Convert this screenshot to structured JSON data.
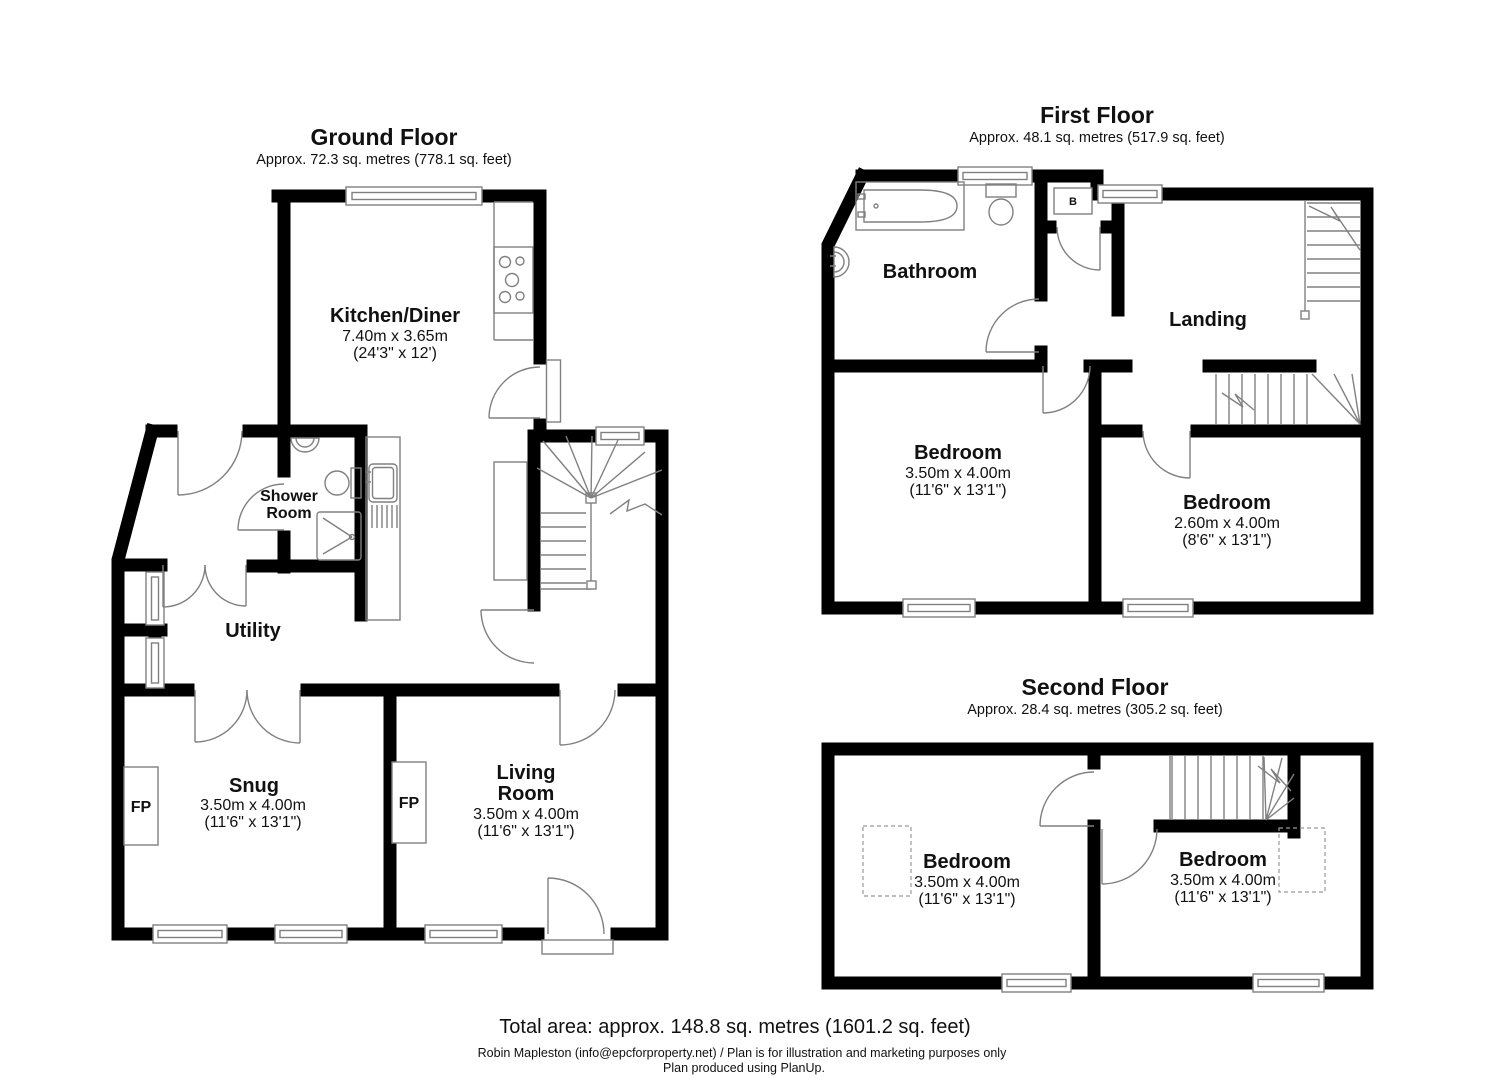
{
  "document": {
    "footer": {
      "total_area": "Total area: approx. 148.8 sq. metres (1601.2 sq. feet)",
      "credit": "Robin Mapleston (info@epcforproperty.net) / Plan is for illustration and marketing purposes only",
      "produced": "Plan produced using PlanUp."
    }
  },
  "floors": {
    "ground": {
      "title": "Ground Floor",
      "area": "Approx. 72.3 sq. metres (778.1 sq. feet)"
    },
    "first": {
      "title": "First Floor",
      "area": "Approx. 48.1 sq. metres (517.9 sq. feet)"
    },
    "second": {
      "title": "Second Floor",
      "area": "Approx. 28.4 sq. metres (305.2 sq. feet)"
    }
  },
  "rooms": {
    "kitchen_diner": {
      "name": "Kitchen/Diner",
      "metric": "7.40m x 3.65m",
      "imperial": "(24'3\" x 12')"
    },
    "shower_room": {
      "line1": "Shower",
      "line2": "Room"
    },
    "utility": {
      "name": "Utility"
    },
    "snug": {
      "name": "Snug",
      "metric": "3.50m x 4.00m",
      "imperial": "(11'6\" x 13'1\")"
    },
    "living_room": {
      "line1": "Living",
      "line2": "Room",
      "metric": "3.50m x 4.00m",
      "imperial": "(11'6\" x 13'1\")"
    },
    "bathroom": {
      "name": "Bathroom"
    },
    "landing": {
      "name": "Landing"
    },
    "first_bedroom_left": {
      "name": "Bedroom",
      "metric": "3.50m x 4.00m",
      "imperial": "(11'6\" x 13'1\")"
    },
    "first_bedroom_right": {
      "name": "Bedroom",
      "metric": "2.60m x 4.00m",
      "imperial": "(8'6\" x 13'1\")"
    },
    "second_bedroom_left": {
      "name": "Bedroom",
      "metric": "3.50m x 4.00m",
      "imperial": "(11'6\" x 13'1\")"
    },
    "second_bedroom_right": {
      "name": "Bedroom",
      "metric": "3.50m x 4.00m",
      "imperial": "(11'6\" x 13'1\")"
    }
  },
  "markers": {
    "fireplace": "FP",
    "boiler": "B"
  },
  "colors": {
    "wall": "#000000",
    "fixture_line": "#808080",
    "background": "#ffffff",
    "text": "#111111"
  }
}
